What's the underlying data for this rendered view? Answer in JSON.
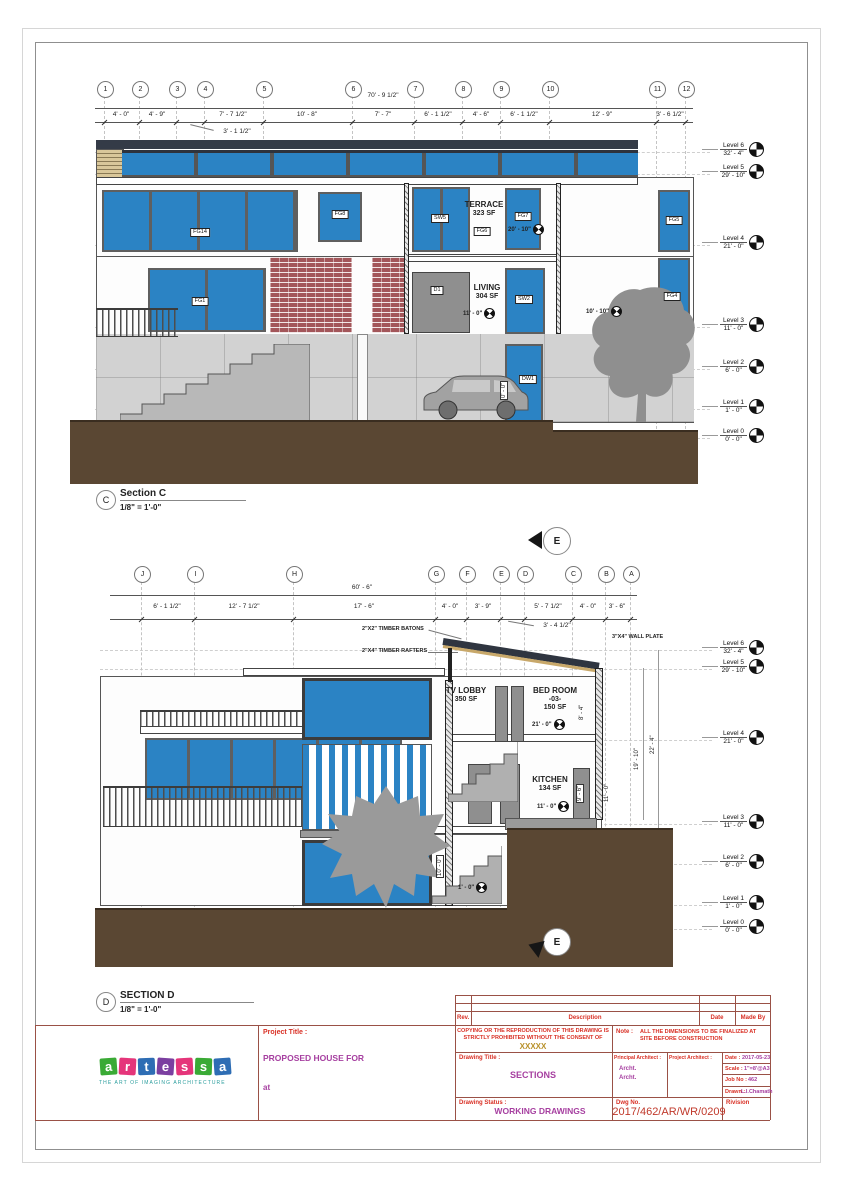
{
  "colors": {
    "window_blue": "#2B83C4",
    "ground_brown": "#5A4733",
    "brick_red": "#A3565A",
    "label_red": "#D93025",
    "value_magenta": "#A63FA0",
    "xxxxx_gold": "#B8912A"
  },
  "levels": [
    {
      "name": "Level 6",
      "elev": "32' - 4\""
    },
    {
      "name": "Level 5",
      "elev": "29' - 10\""
    },
    {
      "name": "Level 4",
      "elev": "21' - 0\""
    },
    {
      "name": "Level 3",
      "elev": "11' - 0\""
    },
    {
      "name": "Level 2",
      "elev": "6' - 0\""
    },
    {
      "name": "Level 1",
      "elev": "1' - 0\""
    },
    {
      "name": "Level 0",
      "elev": "0' - 0\""
    }
  ],
  "section_c": {
    "bubble": "C",
    "title": "Section C",
    "scale": "1/8\" = 1'-0\"",
    "grids": [
      "1",
      "2",
      "3",
      "4",
      "5",
      "6",
      "7",
      "8",
      "9",
      "10",
      "11",
      "12"
    ],
    "overall_dim": "70' - 9 1/2\"",
    "dims": [
      "4' - 0\"",
      "4' - 9\"",
      "7' - 7 1/2\"",
      "10' - 8\"",
      "7' - 7\"",
      "6' - 1 1/2\"",
      "4' - 6\"",
      "6' - 1 1/2\"",
      "12' - 9\"",
      "3' - 6 1/2\""
    ],
    "sub_dim": "3' - 1 1/2\"",
    "rooms": {
      "terrace": {
        "name": "TERRACE",
        "area": "323 SF"
      },
      "living": {
        "name": "LIVING",
        "area": "304 SF"
      }
    },
    "tags": {
      "fg14": "FG14",
      "fg8": "FG8",
      "sw5": "SW5",
      "fg6": "FG6",
      "fg7": "FG7",
      "fg5": "FG5",
      "fg1": "FG1",
      "d1": "D1",
      "sw2": "SW2",
      "fg4": "FG4",
      "dw1": "DW1"
    },
    "spots": {
      "terrace": "20' - 10\"",
      "living": "11' - 0\"",
      "right": "10' - 10\"",
      "garage": "0' - 0\""
    }
  },
  "section_d": {
    "bubble": "D",
    "title": "SECTION D",
    "scale": "1/8\" = 1'-0\"",
    "marker": "E",
    "grids": [
      "J",
      "I",
      "H",
      "G",
      "F",
      "E",
      "D",
      "C",
      "B",
      "A"
    ],
    "overall_dim": "60' - 6\"",
    "dims": [
      "6' - 1 1/2\"",
      "12' - 7 1/2\"",
      "17' - 6\"",
      "4' - 0\"",
      "3' - 9\"",
      "5' - 7 1/2\"",
      "4' - 0\"",
      "3' - 6\""
    ],
    "sub_dim": "3' - 4 1/2\"",
    "annotations": {
      "batons": "2\"X2\" TIMBER BATONS",
      "rafters": "2\"X4\" TIMBER RAFTERS",
      "wallplate": "3\"X4\" WALL PLATE"
    },
    "rooms": {
      "tvlobby": {
        "name": "TV LOBBY",
        "area": "350 SF"
      },
      "bedroom": {
        "name": "BED ROOM",
        "number": "-03-",
        "area": "150 SF"
      },
      "kitchen": {
        "name": "KITCHEN",
        "area": "134 SF"
      }
    },
    "spots": {
      "bedroom": "21' - 0\"",
      "kitchen": "11' - 0\"",
      "lower": "1' - 0\""
    },
    "vdims": {
      "v224": "22' - 4\"",
      "v1910": "19' - 10\"",
      "v110": "11' - 0\"",
      "v84": "8' - 4\"",
      "door": "9' - 6\"",
      "lower": "10' - 0\""
    }
  },
  "titleblock": {
    "logo": {
      "letters": [
        "a",
        "r",
        "t",
        "e",
        "s",
        "s",
        "a"
      ],
      "tagline": "THE ART OF IMAGING ARCHITECTURE"
    },
    "project_title_label": "Project Title :",
    "project_title": "PROPOSED HOUSE FOR",
    "project_at": "at",
    "rev_header": {
      "rev": "Rev.",
      "description": "Description",
      "date": "Date",
      "made_by": "Made By"
    },
    "copyright_line1": "COPYING OR THE REPRODUCTION OF THIS DRAWING IS",
    "copyright_line2": "STRICTLY PROHIBITED WITHOUT THE CONSENT OF",
    "copyright_name": "XXXXX",
    "note_label": "Note :",
    "note": "ALL THE DIMENSIONS TO BE FINALIZED AT SITE BEFORE CONSTRUCTION",
    "drawing_title_label": "Drawing Title :",
    "drawing_title": "SECTIONS",
    "principal_architect_label": "Principal Architect :",
    "archt1": "Archt.",
    "archt2": "Archt.",
    "project_architect_label": "Project Architect :",
    "date_label": "Date :",
    "date": "2017-05-23",
    "scale_label": "Scale :",
    "scale": "1\"=8'@A3",
    "job_label": "Job No :",
    "job": "462",
    "drawn_label": "Drawn :",
    "drawn": "L.I.Chamath",
    "status_label": "Drawing Status :",
    "status": "WORKING DRAWINGS",
    "dwg_label": "Dwg No.",
    "dwg_no": "2017/462/AR/WR/0209",
    "revision_label": "Rivision"
  }
}
